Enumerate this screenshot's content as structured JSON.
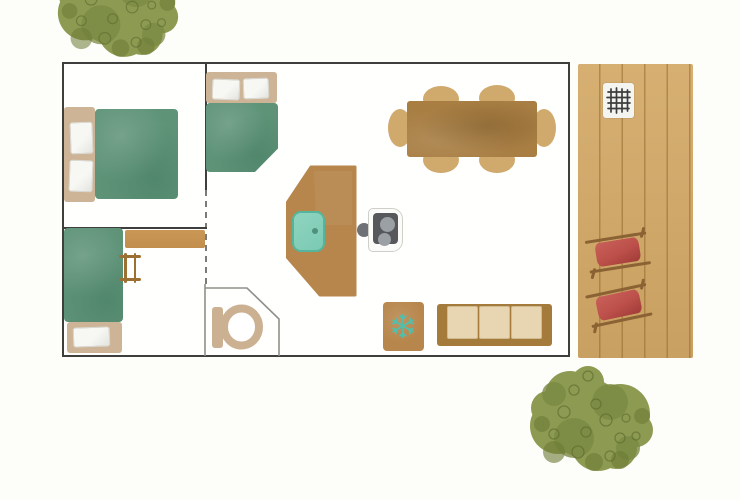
{
  "scene": {
    "type": "watercolor-floor-plan",
    "areas": [
      "bedroom-double",
      "bedroom-double-corner",
      "bedroom-bunk",
      "bathroom",
      "kitchen-living-dining",
      "wooden-deck"
    ],
    "inventory": {
      "furniture": [
        {
          "name": "double-bed",
          "count": 2
        },
        {
          "name": "bunk-bed",
          "count": 1
        },
        {
          "name": "bunk-ladder",
          "count": 1
        },
        {
          "name": "wall-shelf",
          "count": 1
        },
        {
          "name": "kitchen-counter-with-sink",
          "count": 1
        },
        {
          "name": "two-burner-cooktop",
          "count": 1
        },
        {
          "name": "dining-table",
          "count": 1
        },
        {
          "name": "dining-chair",
          "count": 6
        },
        {
          "name": "fridge-with-snowflake",
          "count": 1
        },
        {
          "name": "three-seat-sofa",
          "count": 1
        },
        {
          "name": "toilet",
          "count": 1
        }
      ],
      "deck_items": [
        {
          "name": "bbq-grill",
          "count": 1
        },
        {
          "name": "red-deck-lounger",
          "count": 2
        }
      ],
      "outdoor": [
        {
          "name": "tree",
          "count": 2
        }
      ]
    }
  },
  "colors": {
    "background": "#fdfdf9",
    "room-fill": "#fffffe",
    "outer-wall": "#3e3e3c",
    "interior-wall": "#3e3e3c",
    "bathroom-wall": "#90908a",
    "door-dash": "#7a7a76",
    "bed-green": "#5e9378",
    "bed-frame-tan": "#cdb496",
    "pillow-white": "#f7f7f4",
    "counter-wood": "#b7864c",
    "table-wood": "#a87e43",
    "chair-wood": "#d0a96c",
    "shelf-wood": "#c28e4d",
    "ladder-wood": "#9c6f33",
    "sofa-frame-wood": "#a57b3c",
    "sofa-cushion": "#e8d6b2",
    "deck-wood": "#d3a967",
    "lounger-red": "#bc4f49",
    "lounger-frame": "#8a6233",
    "sink-teal": "#7bcab3",
    "sink-border": "#55b49c",
    "snowflake-teal": "#4fc0ae",
    "stove-body": "#fbfbf9",
    "stove-panel": "#56585c",
    "stove-burner": "#9aa0a4",
    "knob-gray": "#6e7276",
    "grill-white": "#f4f4f1",
    "grill-grid": "#3d3d3d",
    "toilet-tan": "#cbb091",
    "tree-green": "#8d9a52",
    "tree-green-mid": "#7b8a43",
    "tree-green-dark": "#6c7b36",
    "tree-scribble": "#5a682c"
  }
}
